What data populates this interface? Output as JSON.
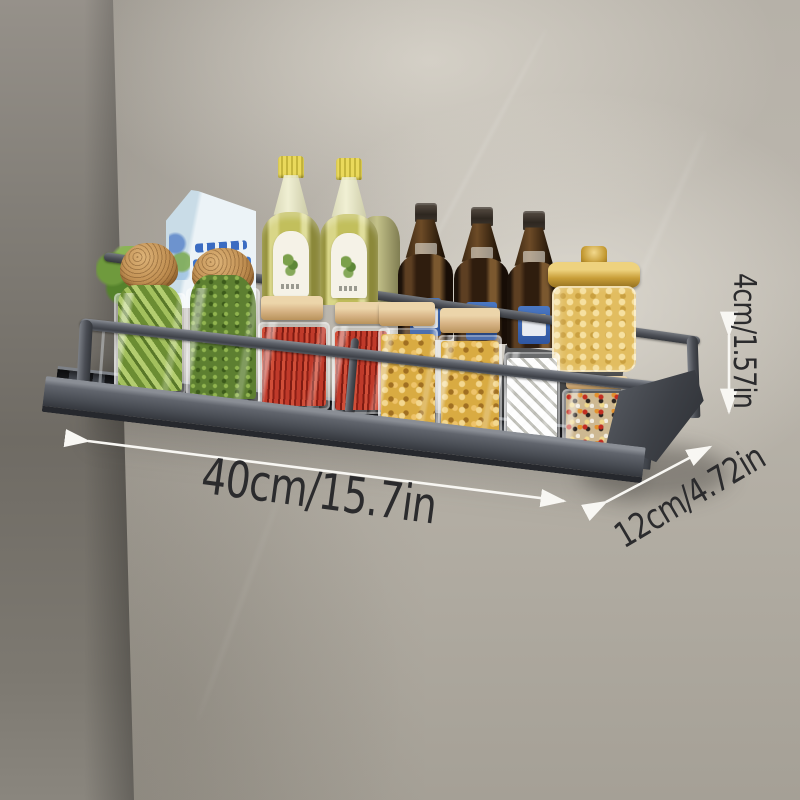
{
  "scene": {
    "description": "Wall-mounted matte grey aluminium kitchen spice rack shelf photographed against a marble wall, loaded with condiment bottles and jars, annotated with product dimensions",
    "dimensions": {
      "width_label": "40cm/15.7in",
      "depth_label": "12cm/4.72in",
      "height_label": "4cm/1.57in"
    },
    "items": [
      "leafy greens jar",
      "cork-top snack jar",
      "cork-top snack jar",
      "milk carton",
      "olive oil bottle",
      "olive oil bottle",
      "oil bottle (back)",
      "dark sauce bottle",
      "dark sauce bottle",
      "dark sauce bottle",
      "pasta jar with gold lid",
      "edamame canister",
      "herb moss canister",
      "red chilli canister",
      "red chilli canister",
      "macaroni canister",
      "macaroni canister",
      "sugar cube canister",
      "candy sprinkle canister"
    ],
    "colors": {
      "wall_light": "#bab5ab",
      "wall_dark": "#75716a",
      "shelf_metal": "#4d5158",
      "arrow": "#f8f7f3",
      "dimension_text": "#2b2b2d",
      "gold_lid": "#c89e38",
      "wood_lid": "#d7b486",
      "oil_yellow": "#c2bf5c",
      "chili_red": "#a92c1f",
      "herb_green": "#5d7f31",
      "pasta_yellow": "#d9ab42",
      "label_blue": "#3d6ab5"
    }
  }
}
